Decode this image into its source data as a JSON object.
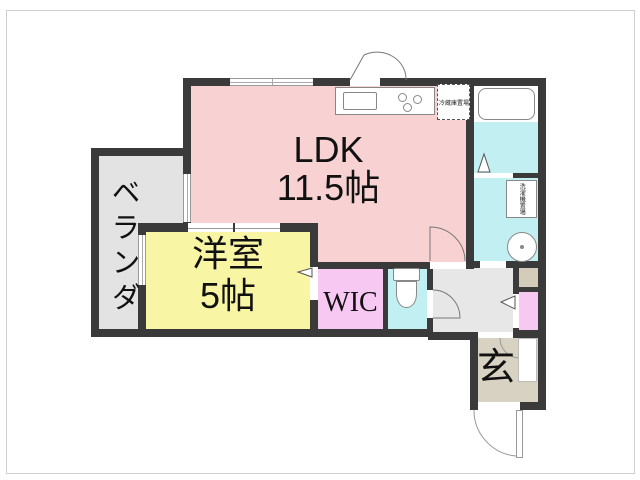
{
  "floorplan": {
    "title": "1LDK apartment floor plan",
    "rooms": {
      "ldk": {
        "name": "LDK",
        "area": "11.5帖"
      },
      "western_room": {
        "name": "洋室",
        "area": "5帖"
      },
      "wic": {
        "name": "WIC"
      },
      "veranda": {
        "name": "ベランダ"
      },
      "entrance": {
        "name": "玄"
      }
    },
    "fixtures": {
      "refrigerator_space": "冷蔵庫置場",
      "washing_machine_space": "洗濯機置場"
    },
    "colors": {
      "ldk": "#f8d2d2",
      "western_room": "#f8f5a4",
      "wic": "#f6c8f2",
      "closet": "#f6c8f2",
      "wet_area": "#c2f0f2",
      "hallway": "#e7e7e7",
      "veranda": "#e3e3e3",
      "entrance_floor": "#d8d2c2",
      "shoe_storage": "#d4ccb8",
      "wall": "#3a3a3a"
    }
  }
}
